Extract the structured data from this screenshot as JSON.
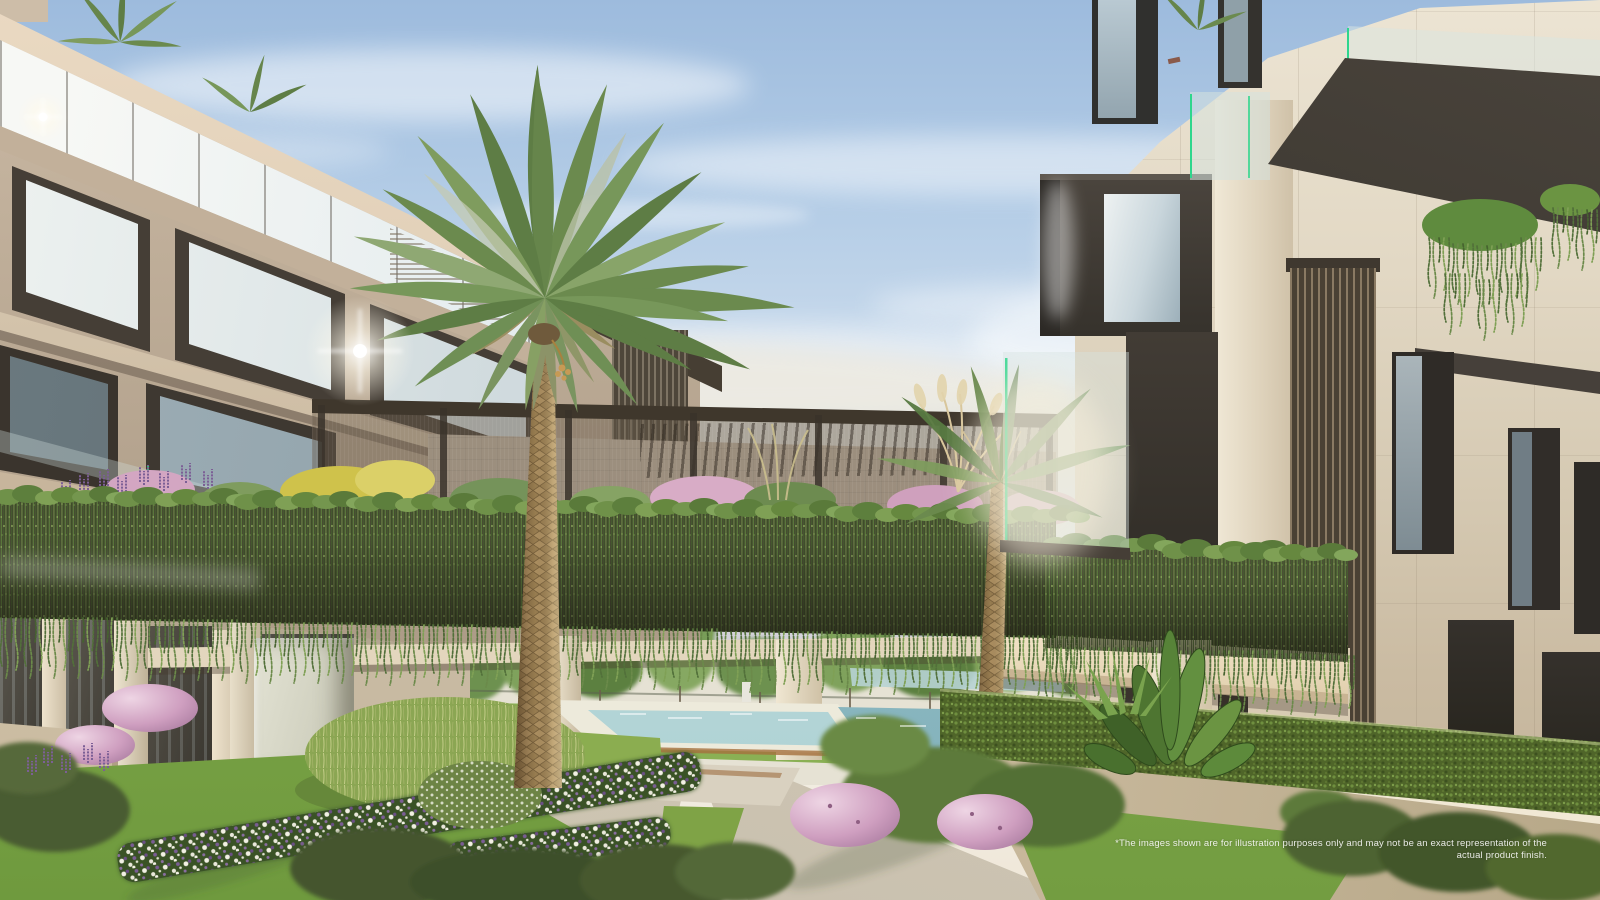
{
  "scene": {
    "disclaimer": "*The images shown are for illustration purposes only and may not be an exact representation of the actual product finish."
  },
  "palette": {
    "sky_top": "#9dbbdd",
    "sky_horizon": "#f1ece1",
    "stone_light": "#e2d8c4",
    "stone_warm": "#c2b09a",
    "charcoal_volume": "#3a342d",
    "glass_reflection": "#c9d8e1",
    "glass_green_edge": "#2fd68c",
    "vine_green": "#5a7a3c",
    "lawn_green": "#86a94e",
    "path_stone": "#ddd5c4",
    "pool_water": "#a9cfd2",
    "flower_pink": "#cf9fc0",
    "flower_purple": "#7c5f96",
    "flower_white": "#f2f0e4",
    "palm_trunk": "#ab8e60",
    "palm_frond": "#6b8a4e"
  }
}
